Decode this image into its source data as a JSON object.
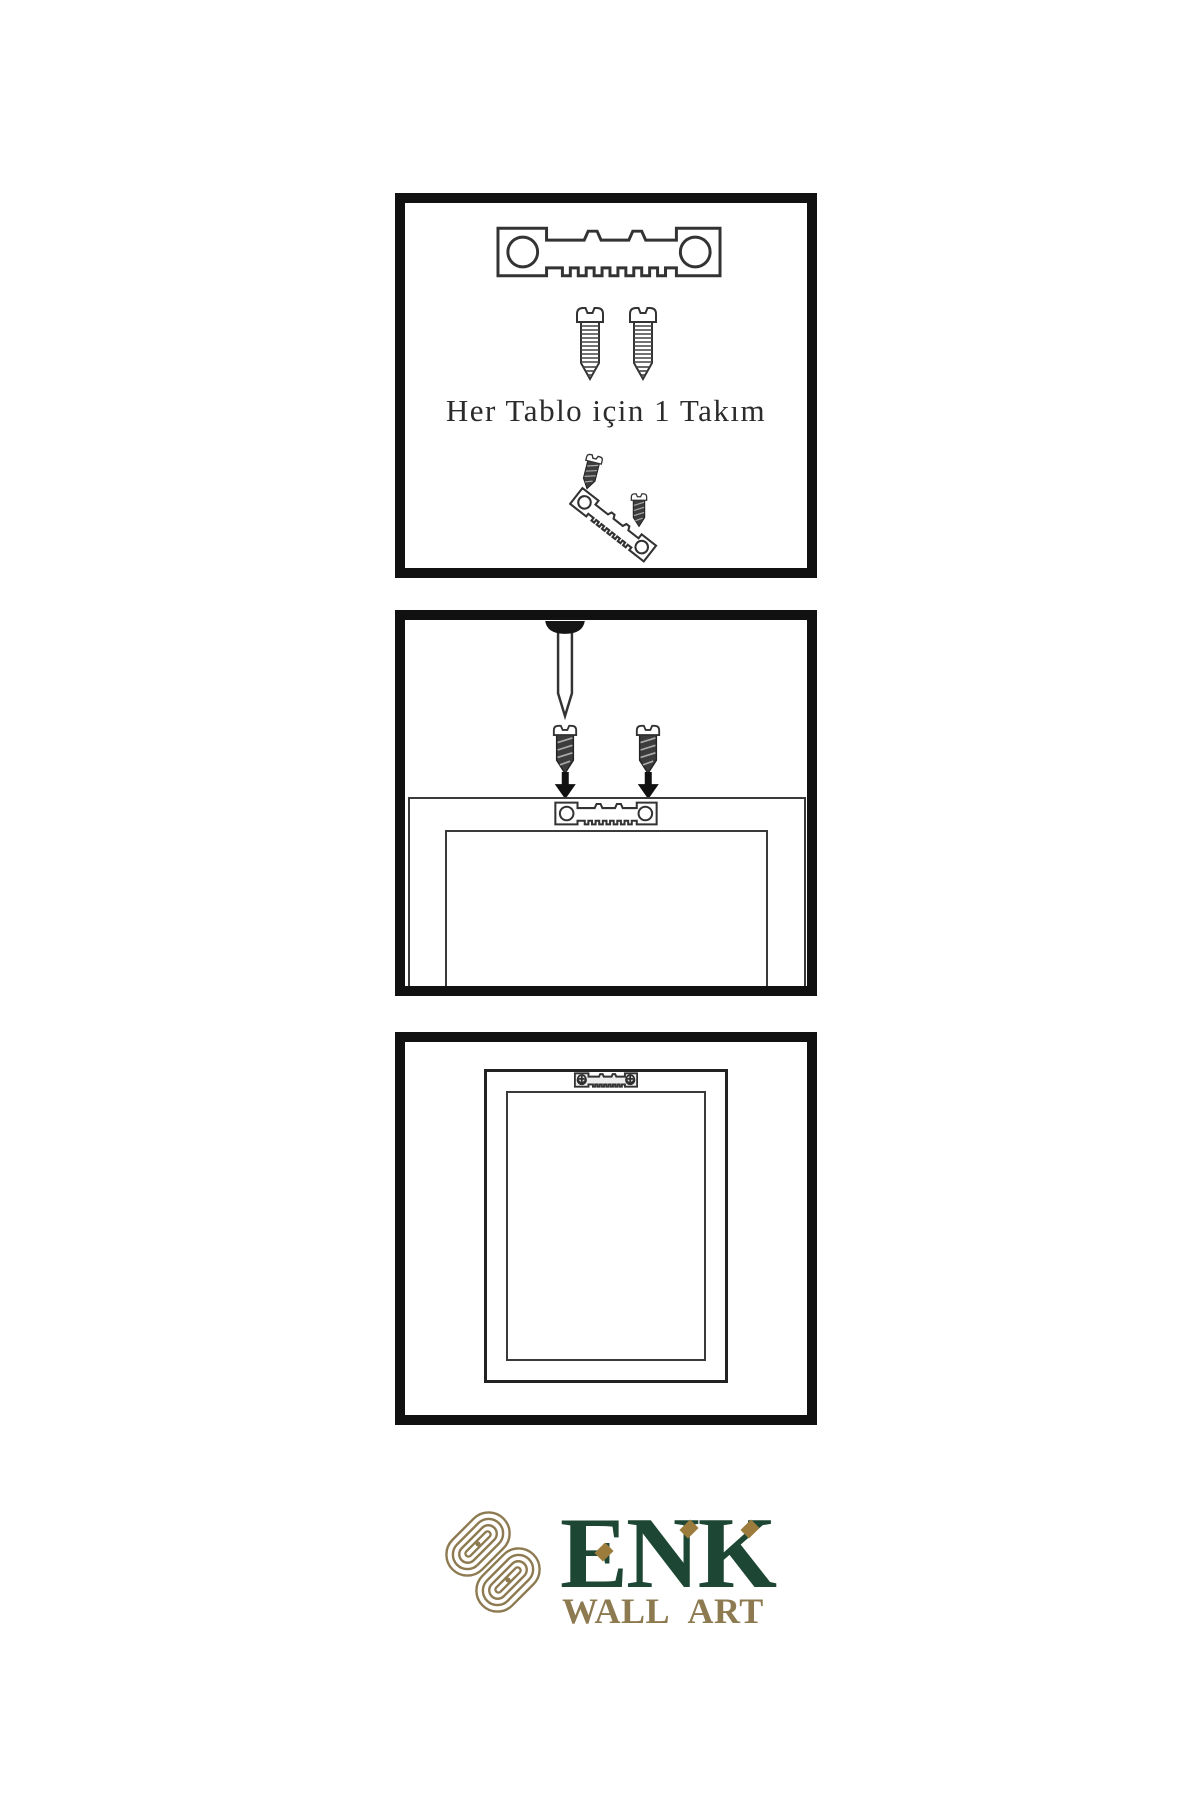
{
  "colors": {
    "background": "#ffffff",
    "panel_border": "#111111",
    "line": "#3a3a3a",
    "ink": "#2b2b2b",
    "screw_dark": "#3c3c3c",
    "brand_green": "#1d4734",
    "brand_gold": "#8d7a50",
    "accent_gold": "#9c7c3c"
  },
  "instructions": {
    "step1": {
      "caption": "Her Tablo için 1 Takım",
      "icons": [
        "sawtooth-hanger-icon",
        "screw-icon",
        "screw-icon",
        "small-screw-icon",
        "tilted-sawtooth-hanger-icon",
        "small-screw-icon"
      ]
    },
    "step2": {
      "icons": [
        "wall-nail-icon",
        "dark-screw-icon",
        "dark-screw-icon",
        "arrow-down-icon",
        "arrow-down-icon",
        "frame-back-icon",
        "sawtooth-hanger-icon"
      ]
    },
    "step3": {
      "icons": [
        "picture-frame-icon",
        "mounted-sawtooth-hanger-icon"
      ]
    }
  },
  "logo": {
    "brand": "ENK",
    "tagline": "WALL ART",
    "emblem": "interlocked-knot-icon"
  }
}
